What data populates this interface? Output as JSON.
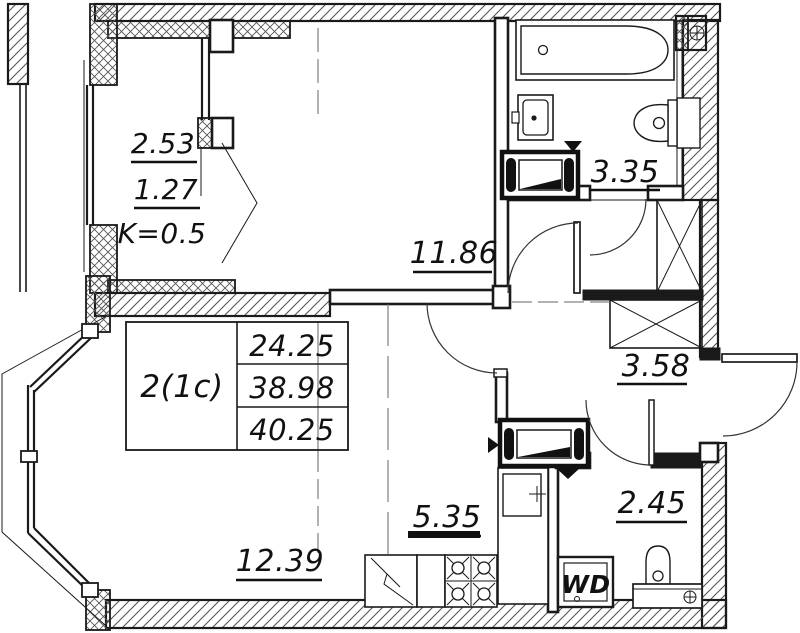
{
  "unit_table": {
    "unit_type": "2(1c)",
    "rows": [
      "24.25",
      "38.98",
      "40.25"
    ]
  },
  "rooms": {
    "balcony": {
      "area": "2.53",
      "reduced_area": "1.27",
      "coefficient": "K=0.5"
    },
    "bedroom": {
      "area": "11.86"
    },
    "bathroom": {
      "area": "3.35"
    },
    "hallway": {
      "area": "3.58"
    },
    "living_room": {
      "area": "12.39"
    },
    "kitchen": {
      "area": "5.35"
    },
    "wc": {
      "area": "2.45"
    }
  },
  "labels": {
    "washer_dryer": "WD"
  },
  "colors": {
    "line": "#1a1a1a",
    "hatch": "#555555",
    "construction": "#666666",
    "background": "#ffffff"
  }
}
